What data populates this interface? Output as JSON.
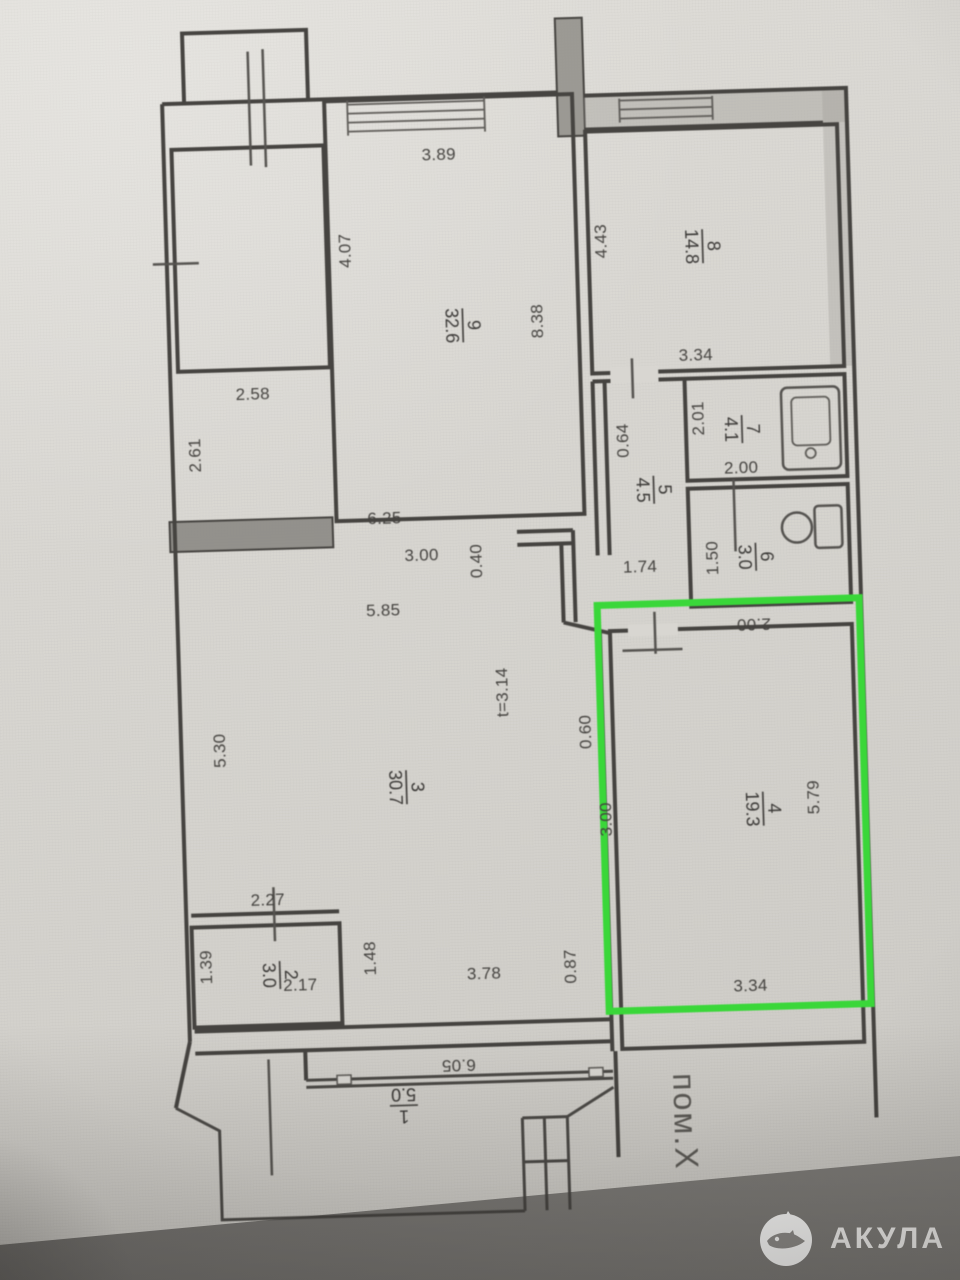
{
  "plan": {
    "highlight_color": "#2fd82f",
    "adjacent_label": "пом.X",
    "rooms": {
      "r1": {
        "num": "1",
        "area": "5.0"
      },
      "r2": {
        "num": "2",
        "area": "3.0"
      },
      "r3": {
        "num": "3",
        "area": "30.7"
      },
      "r4": {
        "num": "4",
        "area": "19.3"
      },
      "r5": {
        "num": "5",
        "area": "4.5"
      },
      "r6": {
        "num": "6",
        "area": "3.0"
      },
      "r7": {
        "num": "7",
        "area": "4.1"
      },
      "r8": {
        "num": "8",
        "area": "14.8"
      },
      "r9": {
        "num": "9",
        "area": "32.6"
      }
    },
    "dims": {
      "top9": "3.89",
      "left9": "4.07",
      "right9": "8.38",
      "left8": "4.43",
      "under8": "3.34",
      "tl_width": "2.58",
      "tl_left": "2.61",
      "bath_w": "2.01",
      "bath_b": "2.00",
      "hall_top": "0.64",
      "hall_b": "1.74",
      "wc_l": "1.50",
      "wc_b": "2.00",
      "c1": "6.25",
      "c2": "3.00",
      "c3": "0.40",
      "c4": "5.85",
      "c5": "t=3.14",
      "left3": "5.30",
      "r1x": "0.60",
      "r2x": "3.00",
      "right4": "5.79",
      "under4": "3.34",
      "top2": "2.27",
      "left2": "1.39",
      "under2": "2.17",
      "right2": "1.48",
      "bottom3": "3.78",
      "b087": "0.87",
      "balc": "6.05"
    }
  },
  "watermark": {
    "brand": "АКУЛА"
  }
}
